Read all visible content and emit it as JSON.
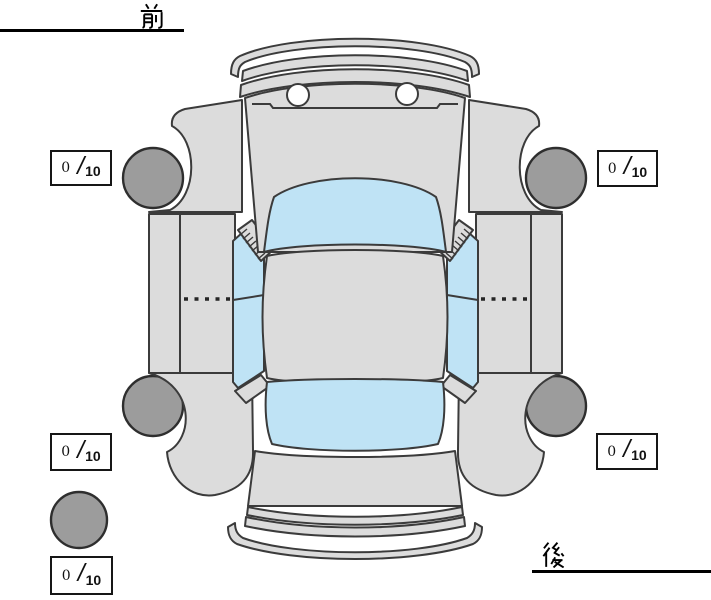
{
  "labels": {
    "front": {
      "text": "前"
    },
    "rear": {
      "text": "後"
    }
  },
  "ratings": {
    "front_left": {
      "value": "0",
      "separator": "/",
      "max": "10"
    },
    "front_right": {
      "value": "0",
      "separator": "/",
      "max": "10"
    },
    "rear_left": {
      "value": "0",
      "separator": "/",
      "max": "10"
    },
    "rear_right": {
      "value": "0",
      "separator": "/",
      "max": "10"
    },
    "spare": {
      "value": "0",
      "separator": "/",
      "max": "10"
    }
  },
  "diagram": {
    "description": "vehicle top view with tire condition scores",
    "colors": {
      "body": "#dcdcdc",
      "glass": "#bfe3f5",
      "tire": "#9c9c9c",
      "outline": "#3b3b3b",
      "headlight": "#ffffff",
      "label": "#000000"
    }
  }
}
